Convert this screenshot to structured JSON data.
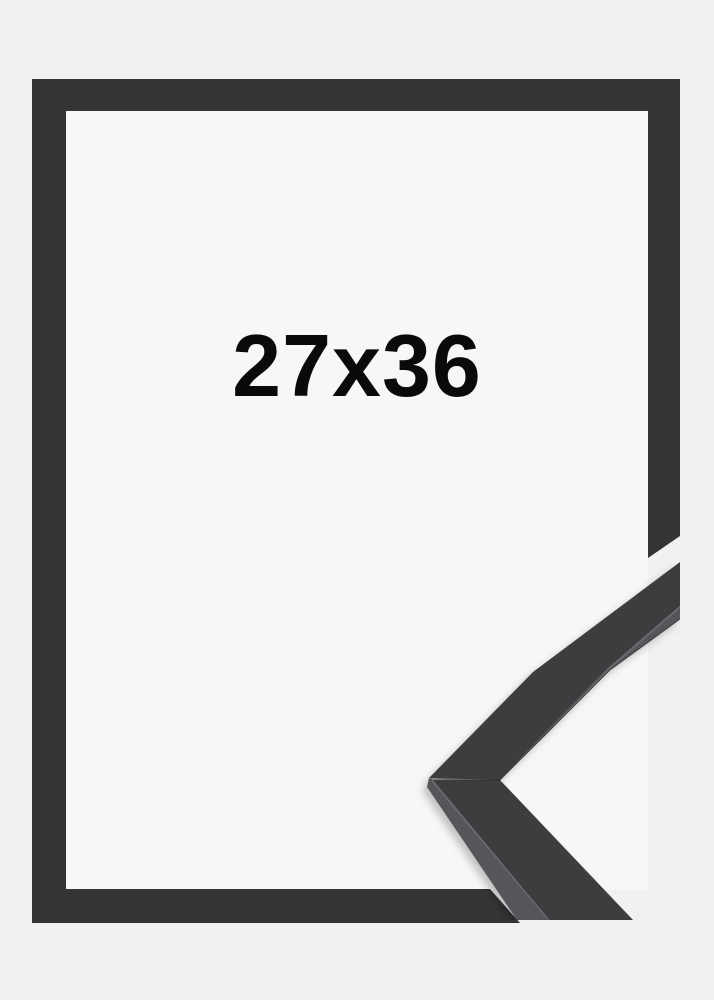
{
  "product": {
    "size_label": "27x36"
  },
  "colors": {
    "page_background": "#f1f1f2",
    "frame_border": "#333436",
    "frame_opening": "#f7f7f8",
    "sample_top_face": "#3c3e3f",
    "sample_side_face": "#54565a",
    "edge_highlight": "#717376",
    "label_text": "#0a0a0a"
  }
}
